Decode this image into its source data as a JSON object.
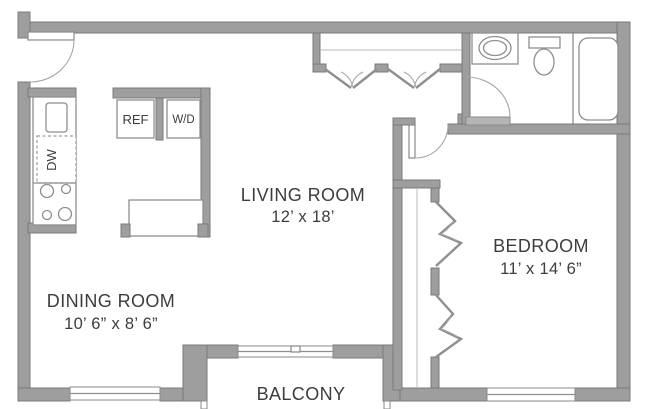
{
  "plan_title": "One-bedroom apartment floor plan",
  "rooms": {
    "living": {
      "name": "LIVING ROOM",
      "dims": "12’ x 18’"
    },
    "dining": {
      "name": "DINING ROOM",
      "dims": "10’ 6” x 8’ 6”"
    },
    "bedroom": {
      "name": "BEDROOM",
      "dims": "11’ x 14’ 6”"
    },
    "balcony": {
      "name": "BALCONY"
    }
  },
  "appliances": {
    "refrigerator": "REF",
    "washer_dryer": "W/D",
    "dishwasher": "DW"
  },
  "colors": {
    "wall_fill": "#9e9e9e",
    "wall_edge": "#7a7a7a",
    "fixture_line": "#8e8e8e",
    "text": "#3d3d3d",
    "background": "#ffffff"
  }
}
